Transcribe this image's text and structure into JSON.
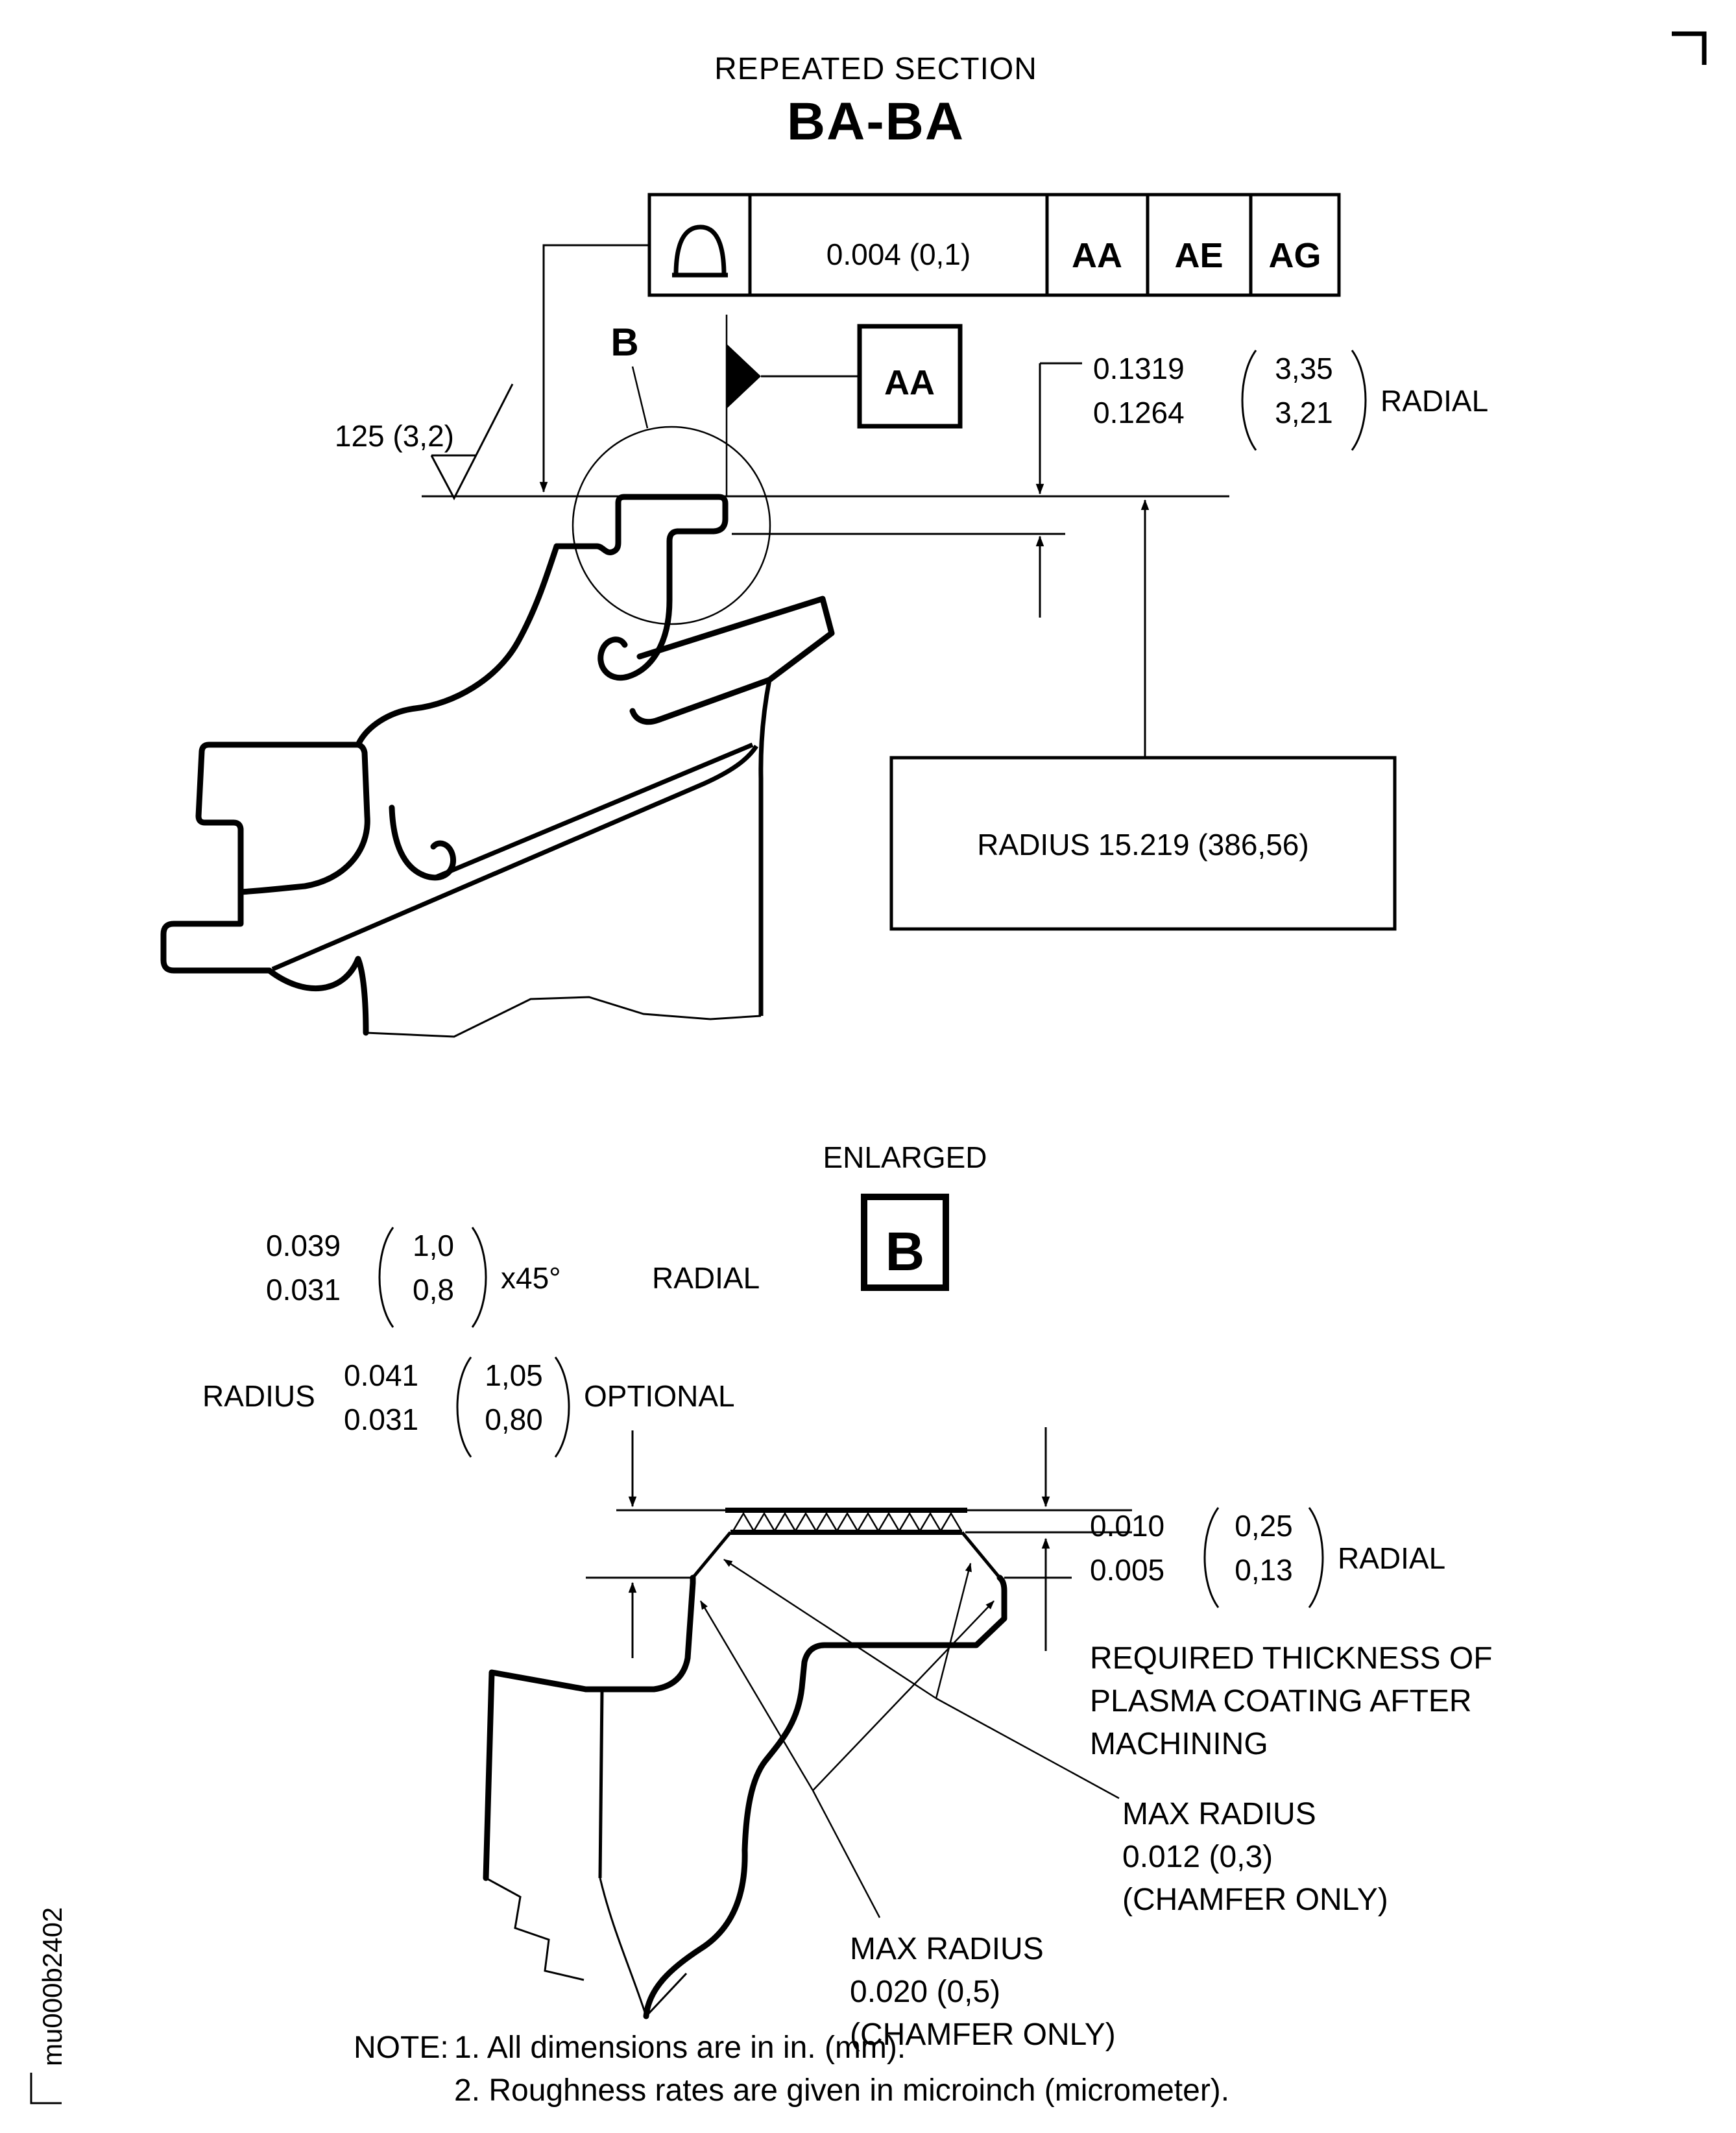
{
  "page": {
    "ink": "#000000",
    "paper": "#ffffff"
  },
  "header": {
    "subtitle": "REPEATED SECTION",
    "title": "BA-BA"
  },
  "fcf": {
    "symbol": "profile-of-surface-icon",
    "tolerance": "0.004 (0,1)",
    "datum1": "AA",
    "datum2": "AE",
    "datum3": "AG"
  },
  "upper_view": {
    "detail_label": "B",
    "datum_flag_label": "AA",
    "surface_finish": "125 (3,2)",
    "radial_dim": {
      "upper": "0.1319",
      "lower": "0.1264",
      "metric_upper": "3,35",
      "metric_lower": "3,21",
      "suffix": "RADIAL"
    },
    "radius_note": "RADIUS 15.219 (386,56)"
  },
  "enlarged_view": {
    "caption": "ENLARGED",
    "detail_label": "B",
    "chamfer_dim": {
      "upper": "0.039",
      "lower": "0.031",
      "metric_upper": "1,0",
      "metric_lower": "0,8",
      "angle": "x45°",
      "suffix": "RADIAL"
    },
    "optional_radius": {
      "prefix": "RADIUS",
      "upper": "0.041",
      "lower": "0.031",
      "metric_upper": "1,05",
      "metric_lower": "0,80",
      "suffix": "OPTIONAL"
    },
    "coating_dim": {
      "upper": "0.010",
      "lower": "0.005",
      "metric_upper": "0,25",
      "metric_lower": "0,13",
      "suffix": "RADIAL"
    },
    "coating_note_1": "REQUIRED THICKNESS OF",
    "coating_note_2": "PLASMA COATING AFTER",
    "coating_note_3": "MACHINING",
    "max_radius_top_1": "MAX RADIUS",
    "max_radius_top_2": "0.012 (0,3)",
    "max_radius_top_3": "(CHAMFER ONLY)",
    "max_radius_bottom_1": "MAX RADIUS",
    "max_radius_bottom_2": "0.020 (0,5)",
    "max_radius_bottom_3": "(CHAMFER ONLY)"
  },
  "notes": {
    "label": "NOTE:",
    "item1": "1. All dimensions are in in. (mm).",
    "item2": "2. Roughness rates are given in microinch (micrometer)."
  },
  "doc_code": "mu000b2402"
}
